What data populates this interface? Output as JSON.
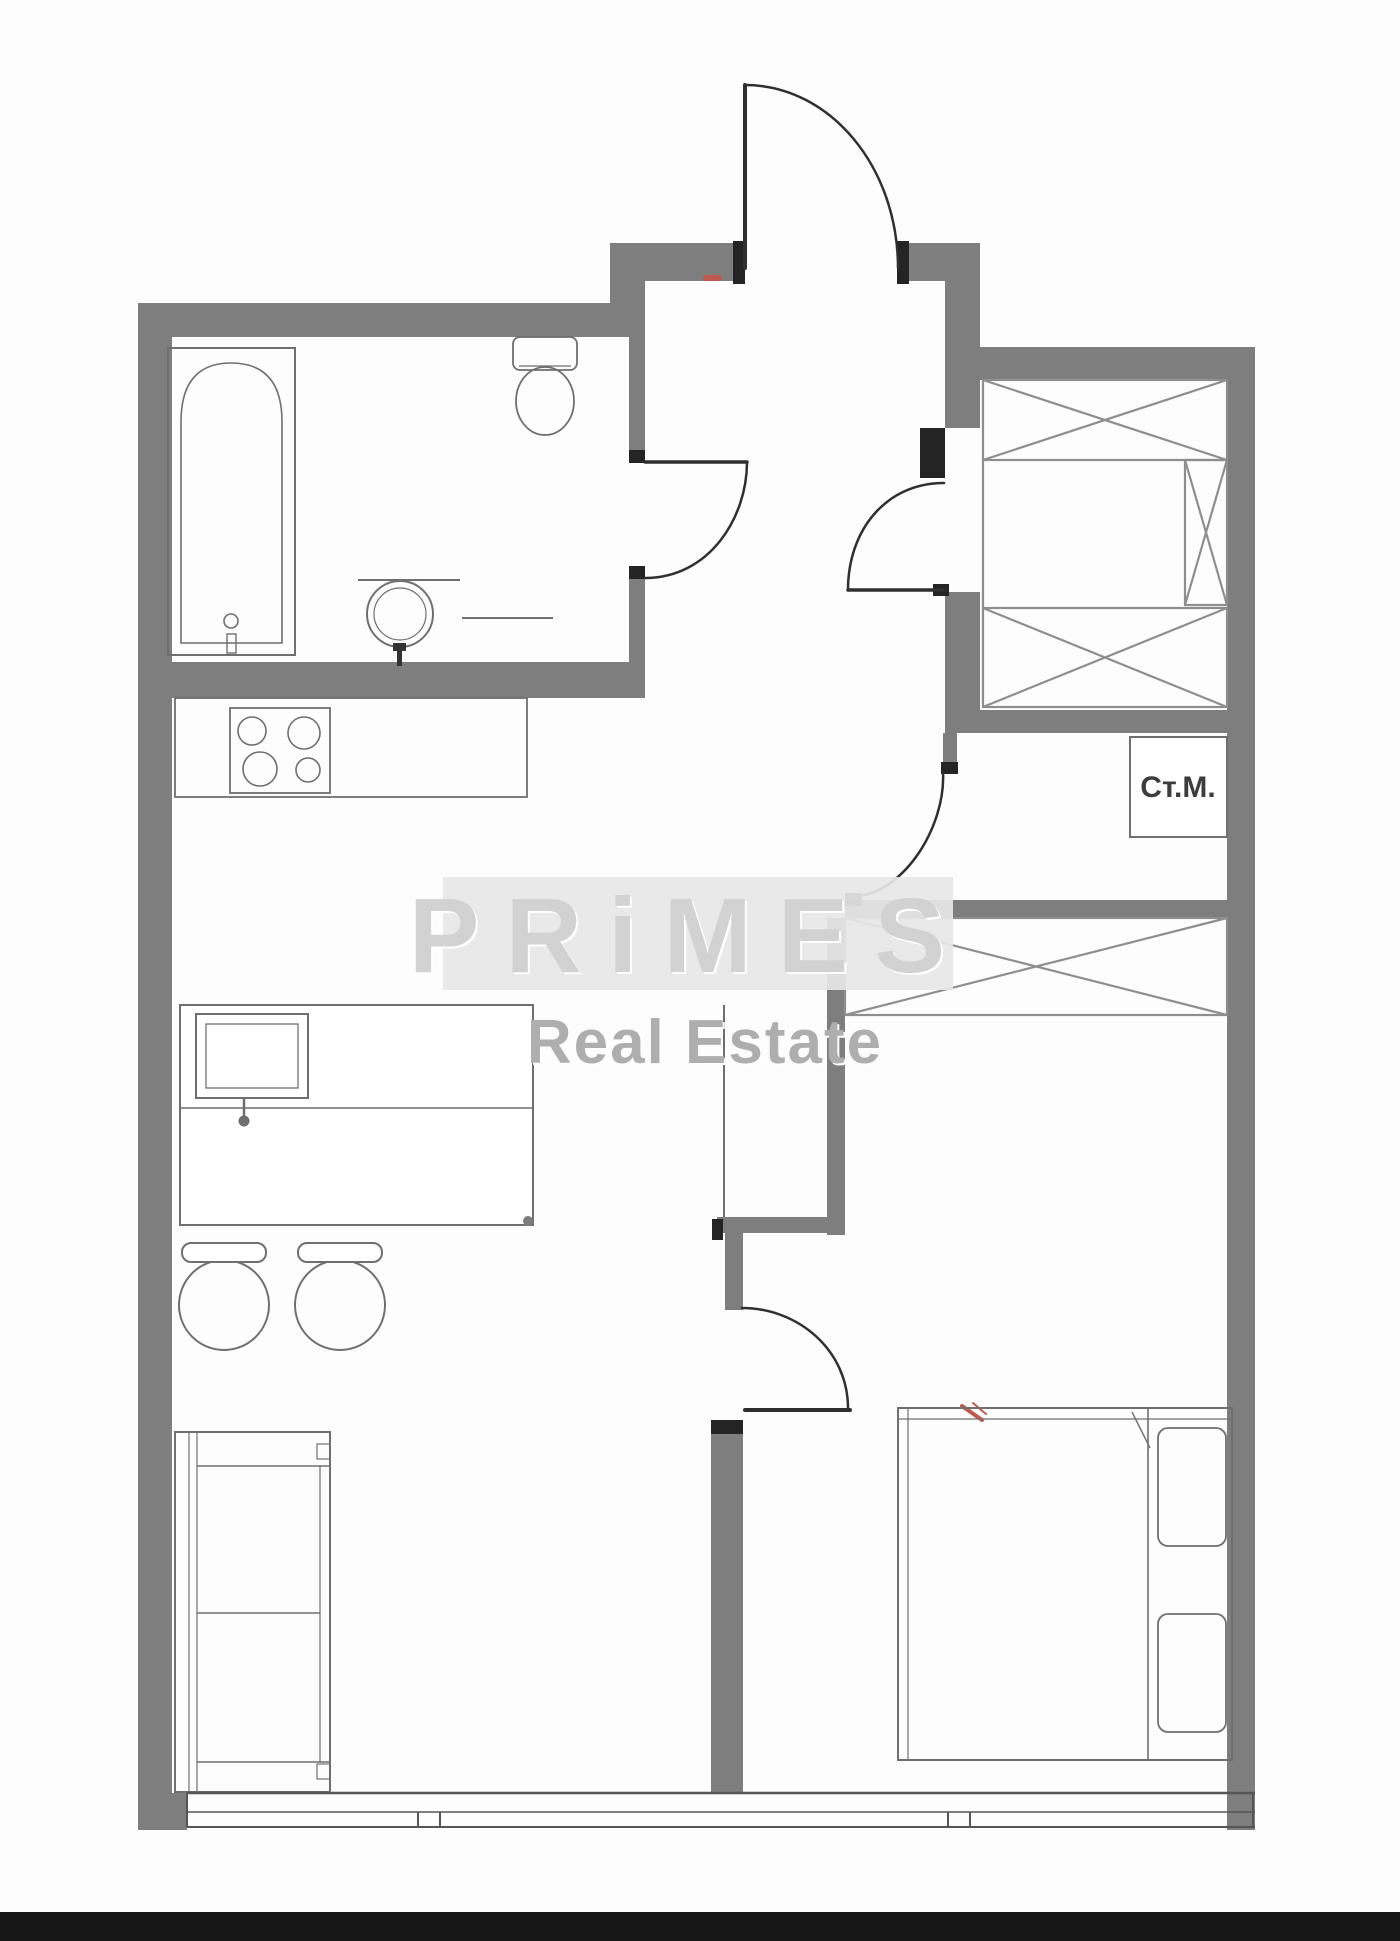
{
  "labels": {
    "washing_machine": "Ст.М."
  },
  "watermark": {
    "brand": "PRiMES",
    "subtitle": "Real Estate"
  },
  "colors": {
    "background": "#fdfdfd",
    "wall": "#7e7e7e",
    "jamb": "#242424",
    "door": "#2f2f2f",
    "line": "#6f6f6f",
    "inner_line": "#8a8a8a",
    "xline": "#8e8e8e",
    "window": "#555555",
    "watermark_band": "#e7e7e7",
    "watermark_text": "#d2d2d2",
    "watermark_shadow": "#ffffff",
    "watermark_subtitle": "#aeaeae",
    "label_text": "#3d3d3d",
    "accent_red": "#c0584f",
    "bottom_bar": "#171717",
    "fixture_dark": "#333333"
  }
}
